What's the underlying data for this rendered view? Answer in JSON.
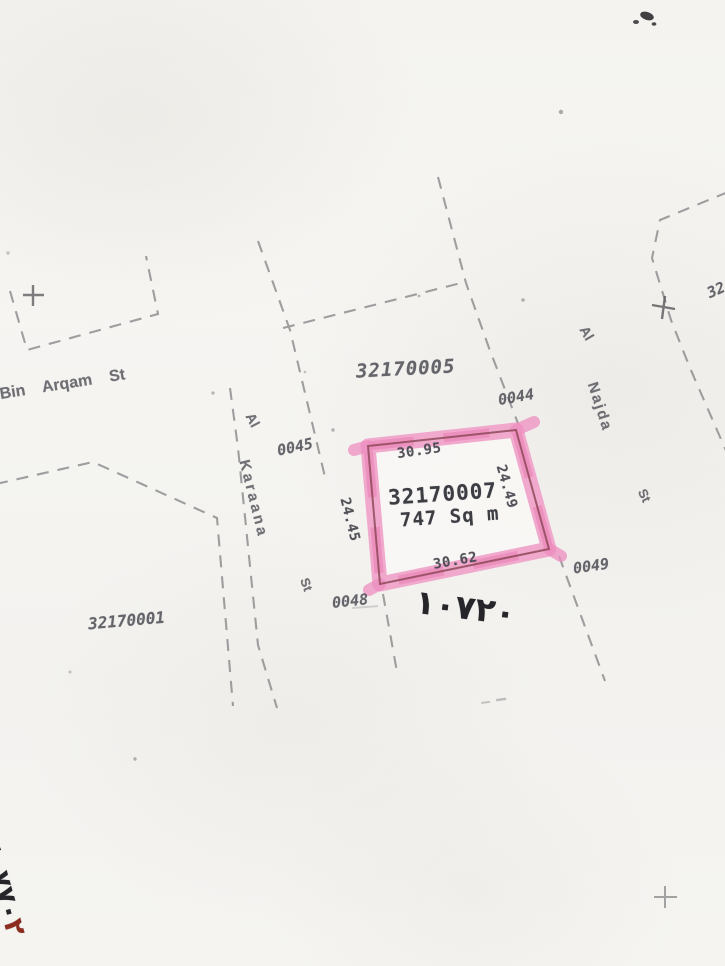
{
  "document": {
    "type": "cadastral-survey-map-scan"
  },
  "colors": {
    "paper": "#f5f4f1",
    "boundary_line": "#8b8b8d",
    "ink_text": "#55555c",
    "highlight_pink": "#f0a0c9",
    "highlight_pink_deep": "#e671ab",
    "parcel_outline": "#8a4352",
    "handwriting_ink": "#26262a",
    "handwriting_red": "#8d2d20"
  },
  "parcel": {
    "number": "32170007",
    "area": "747 Sq m",
    "dimensions": {
      "top": "30.95",
      "right": "24.49",
      "bottom": "30.62",
      "left": "24.45"
    }
  },
  "adjacent": {
    "block_north": "32170005",
    "block_southwest": "32170001",
    "lot_0044": "0044",
    "lot_0045": "0045",
    "lot_0048": "0048",
    "lot_0049": "0049",
    "edge_partial_number": "32"
  },
  "streets": {
    "bin_arqam": "Bin Arqam St",
    "karaana_al": "Al",
    "karaana_name": "Karaana",
    "karaana_st": "St",
    "najda_al": "Al",
    "najda_name": "Najda",
    "najda_st": "St"
  },
  "annotations": {
    "handwritten_center": "١٠٧٢٠",
    "handwritten_left": "٤٠٧٧٠",
    "handwritten_left_red": "٢"
  }
}
